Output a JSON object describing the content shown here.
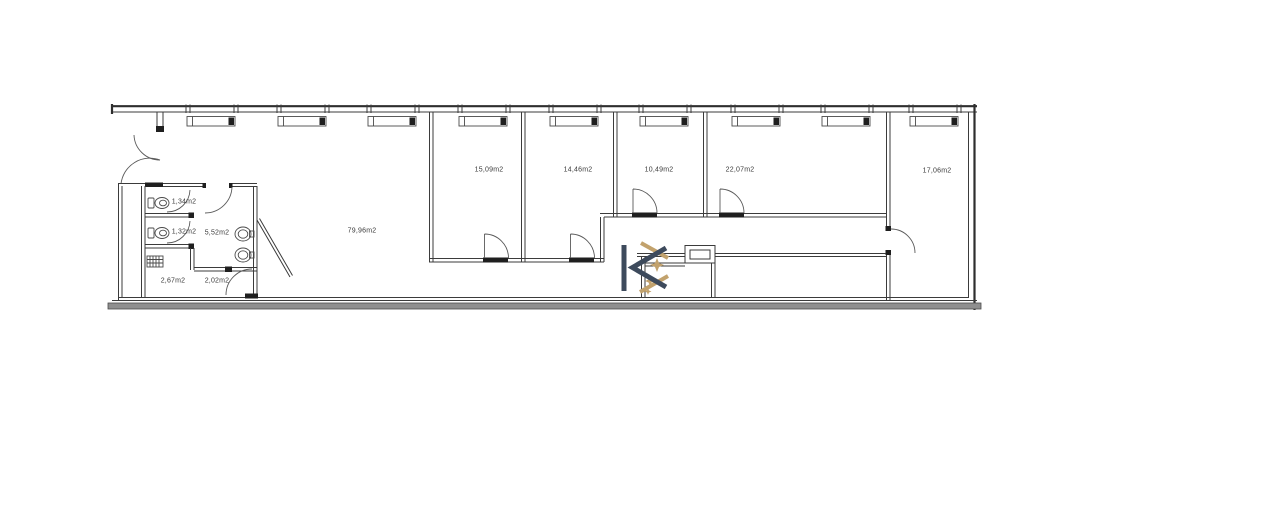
{
  "document": {
    "type": "architectural floor plan",
    "unit_suffix": "m2"
  },
  "rooms": [
    {
      "id": "open-space",
      "area": "79,96m2"
    },
    {
      "id": "room-1",
      "area": "15,09m2"
    },
    {
      "id": "room-2",
      "area": "14,46m2"
    },
    {
      "id": "room-3",
      "area": "10,49m2"
    },
    {
      "id": "room-4",
      "area": "22,07m2"
    },
    {
      "id": "room-5",
      "area": "17,06m2"
    },
    {
      "id": "washroom",
      "area": "5,52m2"
    },
    {
      "id": "wc-1",
      "area": "1,34m2"
    },
    {
      "id": "wc-2",
      "area": "1,32m2"
    },
    {
      "id": "side-room-1",
      "area": "2,67m2"
    },
    {
      "id": "side-room-2",
      "area": "2,02m2"
    }
  ],
  "logo": {
    "description": "K monogram logo",
    "color_navy": "#3d4a5c",
    "color_gold": "#c2a26d"
  },
  "colors": {
    "wall_line": "#3b3b3b",
    "threshold_black": "#1f1f1f",
    "bottom_band_gray": "#8f8f8f",
    "background": "#ffffff"
  }
}
